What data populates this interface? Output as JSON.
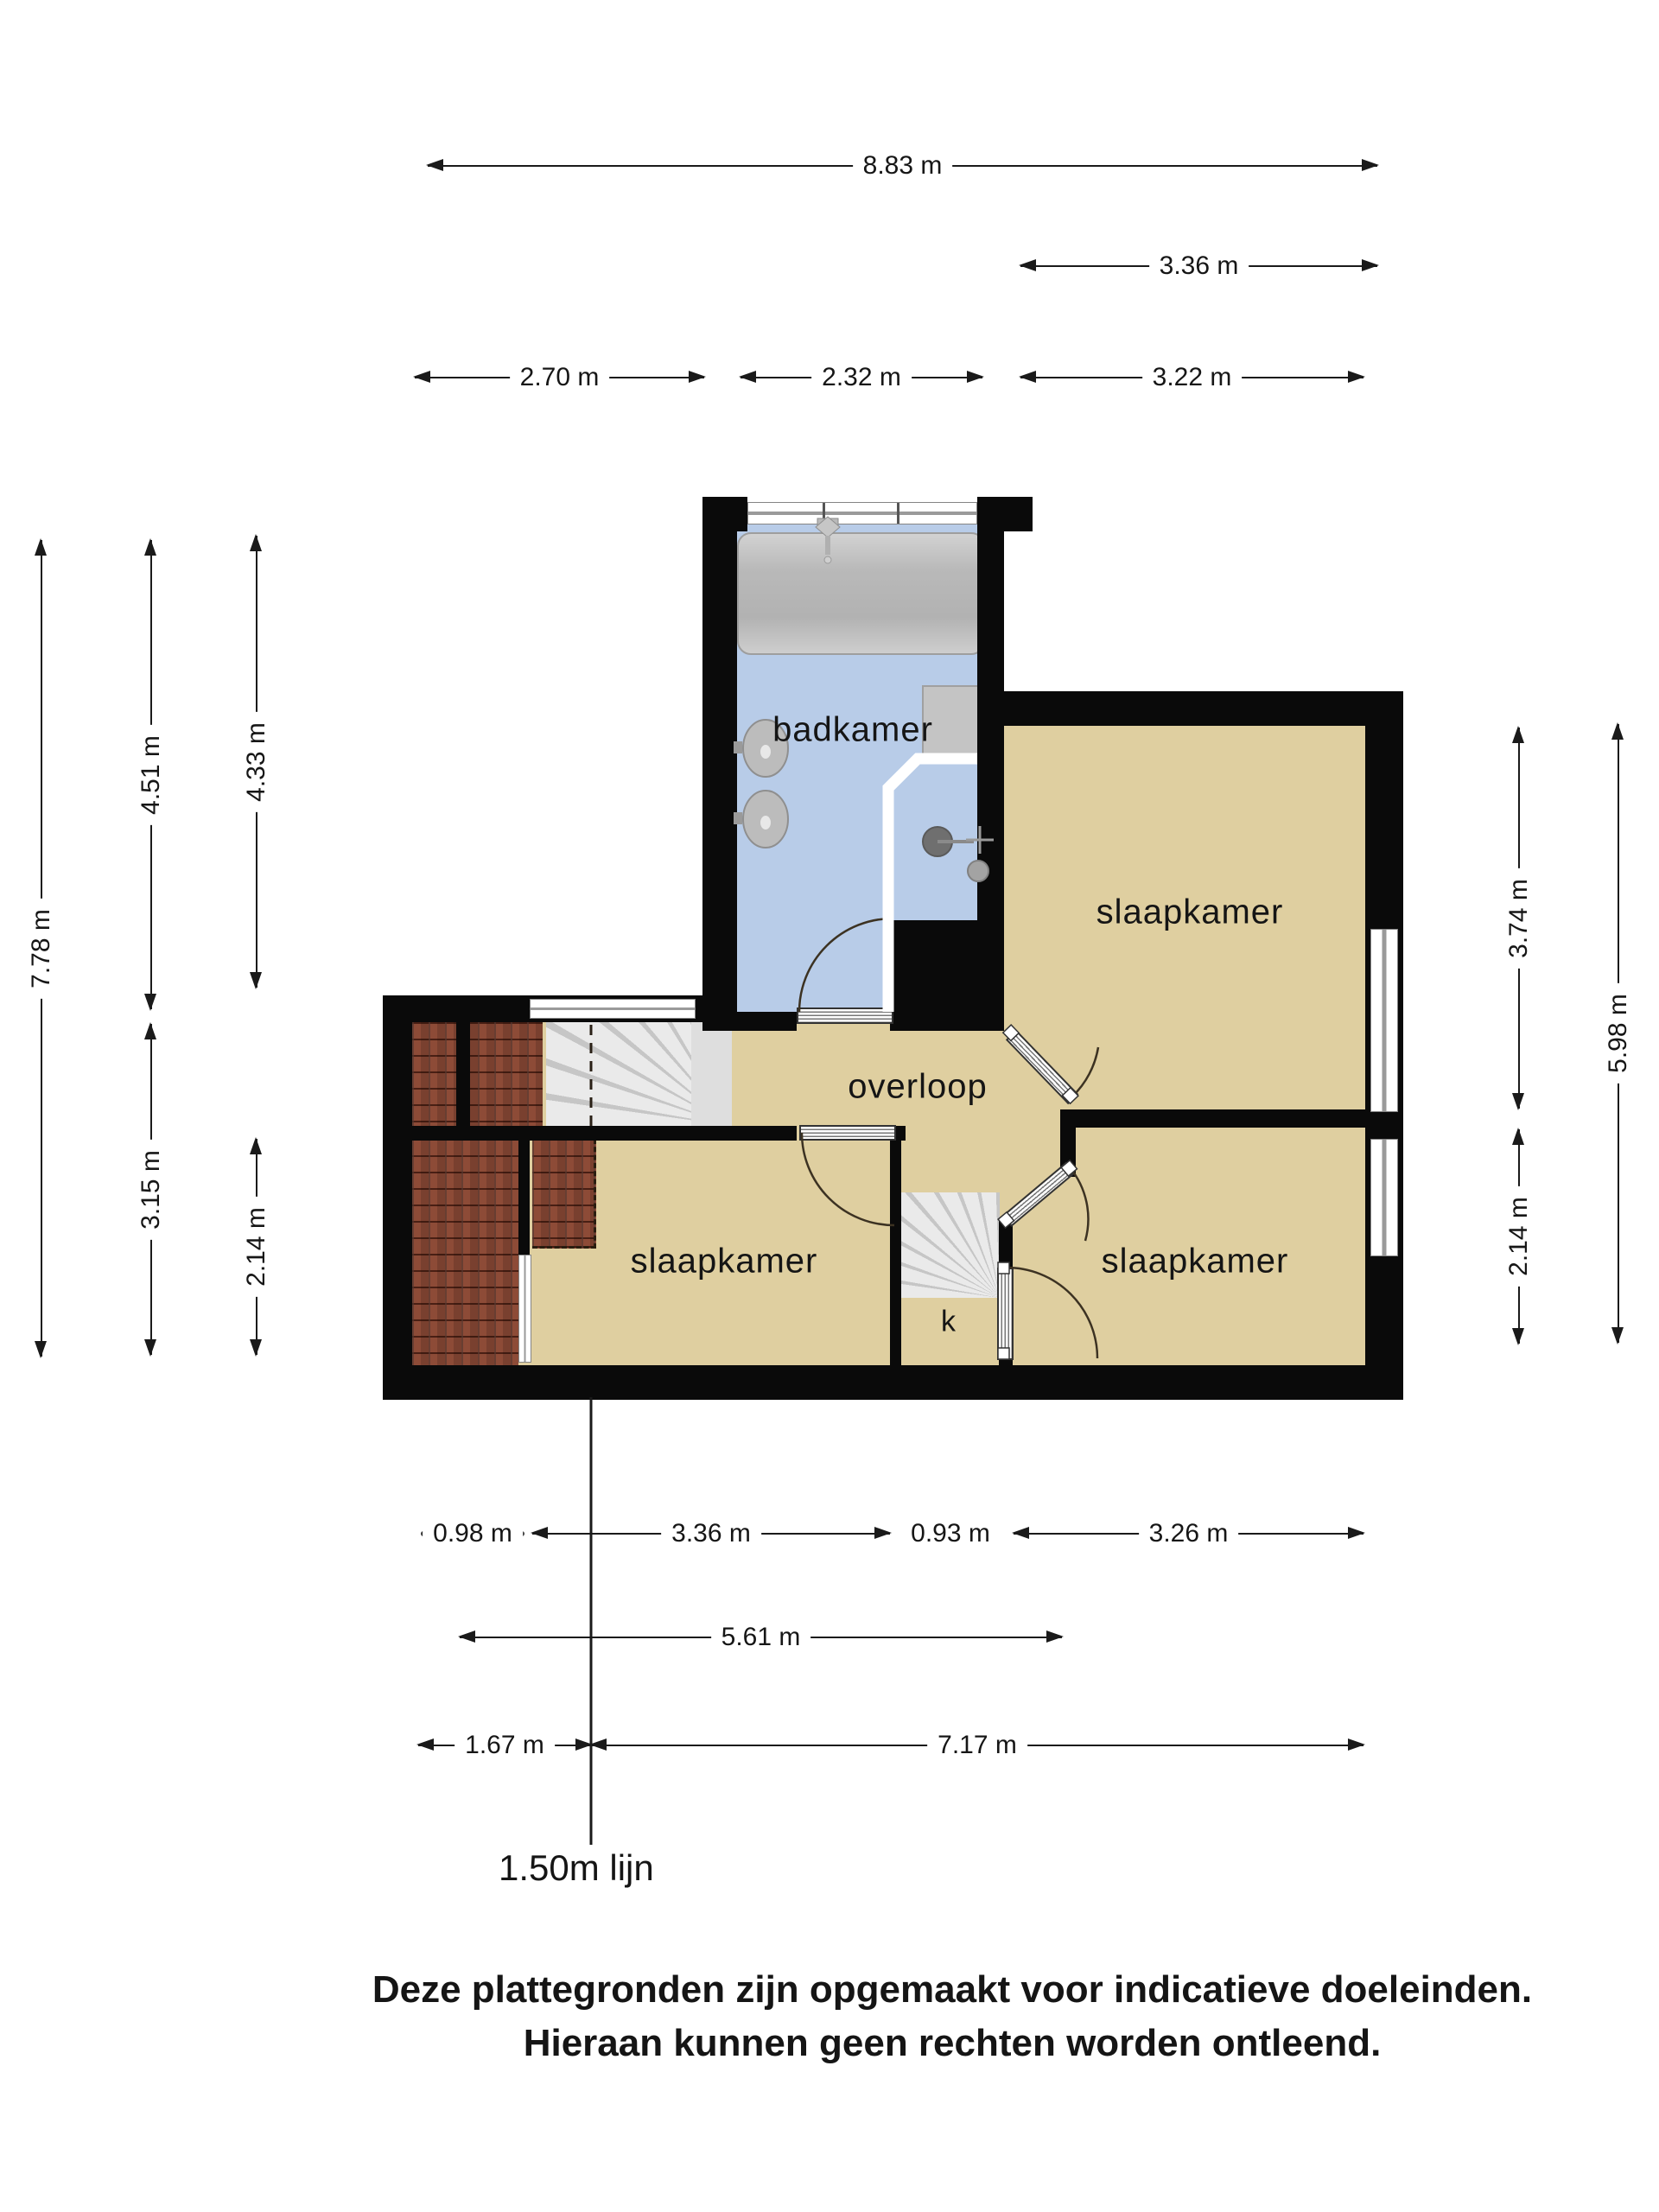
{
  "floorplan": {
    "rooms": [
      {
        "id": "badkamer",
        "label": "badkamer"
      },
      {
        "id": "slaapkamer-top-right",
        "label": "slaapkamer"
      },
      {
        "id": "overloop",
        "label": "overloop"
      },
      {
        "id": "slaapkamer-bottom-left",
        "label": "slaapkamer"
      },
      {
        "id": "slaapkamer-bottom-right",
        "label": "slaapkamer"
      },
      {
        "id": "kast",
        "label": "k"
      }
    ],
    "height_line_label": "1.50m lijn"
  },
  "dimensions": {
    "top": [
      {
        "label": "8.83 m"
      },
      {
        "label": "3.36 m"
      },
      {
        "label": "2.70 m"
      },
      {
        "label": "2.32 m"
      },
      {
        "label": "3.22 m"
      }
    ],
    "bottom": [
      {
        "label": "0.98 m"
      },
      {
        "label": "3.36 m"
      },
      {
        "label": "0.93 m"
      },
      {
        "label": "3.26 m"
      },
      {
        "label": "5.61 m"
      },
      {
        "label": "1.67 m"
      },
      {
        "label": "7.17 m"
      }
    ],
    "left": [
      {
        "label": "7.78 m"
      },
      {
        "label": "4.51 m"
      },
      {
        "label": "4.33 m"
      },
      {
        "label": "3.15 m"
      },
      {
        "label": "2.14 m"
      }
    ],
    "right": [
      {
        "label": "3.74 m"
      },
      {
        "label": "2.14 m"
      },
      {
        "label": "5.98 m"
      }
    ]
  },
  "footer": {
    "line1": "Deze plattegronden zijn opgemaakt voor indicatieve doeleinden.",
    "line2": "Hieraan kunnen geen rechten worden ontleend."
  },
  "colors": {
    "wall": "#0a0a0a",
    "floor_tan": "#dfcfa0",
    "floor_blue": "#b8cce8",
    "brick": "#8d4b37",
    "stair_gray": "#d9d9d9",
    "dimension_line": "#1a1a1a"
  }
}
